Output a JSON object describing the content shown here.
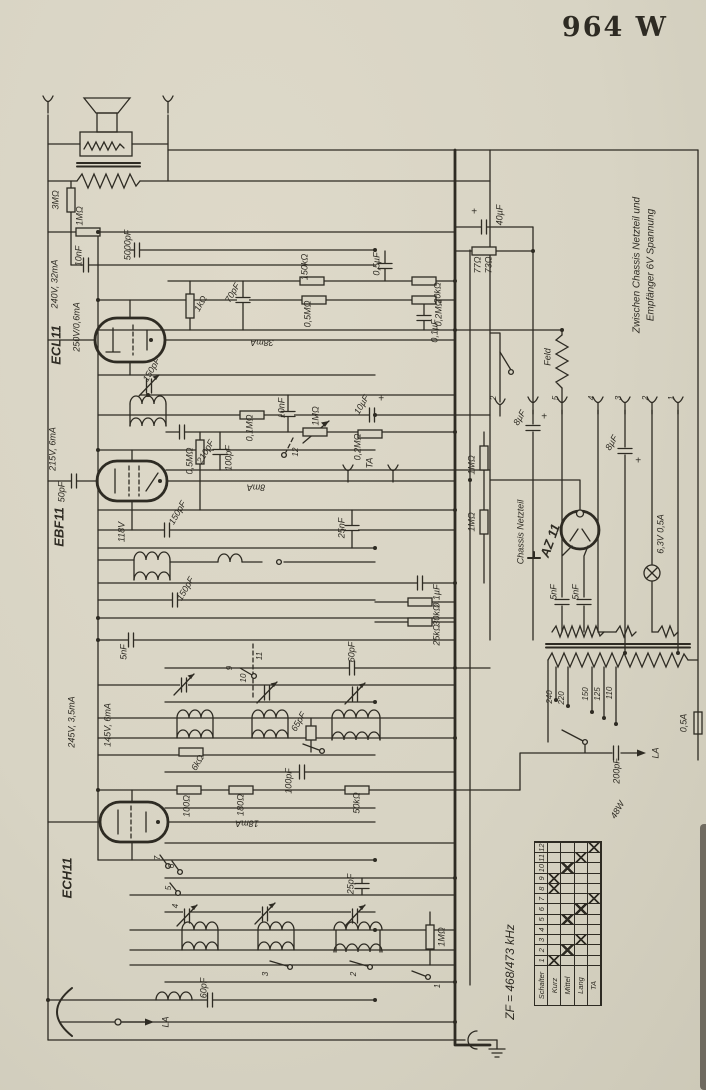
{
  "title": "964 W",
  "colors": {
    "paper": "#d8d4c4",
    "ink": "#2e2b23"
  },
  "switch_table": {
    "header_col": "Schalter",
    "columns": [
      "1",
      "2",
      "3",
      "4",
      "5",
      "6",
      "7",
      "8",
      "9",
      "10",
      "11",
      "12"
    ],
    "rows": [
      {
        "label": "Kurz",
        "marks": [
          1,
          8,
          9
        ]
      },
      {
        "label": "Mittel",
        "marks": [
          2,
          5,
          10
        ]
      },
      {
        "label": "Lang",
        "marks": [
          3,
          6,
          11
        ]
      },
      {
        "label": "TA",
        "marks": [
          7,
          12
        ]
      }
    ]
  },
  "labels": [
    {
      "t": "ECL11",
      "x": 57,
      "y": 345,
      "r": -90,
      "fs": 13,
      "b": 1
    },
    {
      "t": "EBF11",
      "x": 60,
      "y": 527,
      "r": -90,
      "fs": 13,
      "b": 1
    },
    {
      "t": "ECH11",
      "x": 68,
      "y": 878,
      "r": -90,
      "fs": 13,
      "b": 1
    },
    {
      "t": "AZ 11",
      "x": 551,
      "y": 541,
      "r": -70,
      "fs": 13,
      "b": 1
    },
    {
      "t": "3MΩ",
      "x": 56,
      "y": 200,
      "r": -90
    },
    {
      "t": "1MΩ",
      "x": 80,
      "y": 216,
      "r": -90
    },
    {
      "t": "5000pF",
      "x": 128,
      "y": 245,
      "r": -90
    },
    {
      "t": "10nF",
      "x": 79,
      "y": 256,
      "r": -90
    },
    {
      "t": "240V, 32mA",
      "x": 55,
      "y": 284,
      "r": -90
    },
    {
      "t": "250V/0,6mA",
      "x": 77,
      "y": 327,
      "r": -90
    },
    {
      "t": "1kΩ",
      "x": 201,
      "y": 304,
      "r": -60
    },
    {
      "t": "70pF",
      "x": 233,
      "y": 293,
      "r": -60
    },
    {
      "t": "150kΩ",
      "x": 305,
      "y": 267,
      "r": -90
    },
    {
      "t": "0,5µF",
      "x": 377,
      "y": 264,
      "r": -90
    },
    {
      "t": "20kΩ",
      "x": 438,
      "y": 293,
      "r": -90
    },
    {
      "t": "0,5MΩ",
      "x": 308,
      "y": 314,
      "r": -90
    },
    {
      "t": "0,2MΩ",
      "x": 439,
      "y": 313,
      "r": -90
    },
    {
      "t": "0,1µF",
      "x": 435,
      "y": 331,
      "r": -90
    },
    {
      "t": "38mA",
      "x": 262,
      "y": 342,
      "r": 180
    },
    {
      "t": "150pF",
      "x": 152,
      "y": 370,
      "r": -60
    },
    {
      "t": "215V, 6mA",
      "x": 53,
      "y": 449,
      "r": -90
    },
    {
      "t": "50pF",
      "x": 62,
      "y": 492,
      "r": -90
    },
    {
      "t": "118V",
      "x": 122,
      "y": 532,
      "r": -90
    },
    {
      "t": "210pF",
      "x": 206,
      "y": 452,
      "r": -60
    },
    {
      "t": "0,5MΩ",
      "x": 190,
      "y": 461,
      "r": -90
    },
    {
      "t": "100pF",
      "x": 229,
      "y": 458,
      "r": -90
    },
    {
      "t": "0,1MΩ",
      "x": 250,
      "y": 428,
      "r": -90
    },
    {
      "t": "10nF",
      "x": 282,
      "y": 408,
      "r": -90
    },
    {
      "t": "8mA",
      "x": 256,
      "y": 487,
      "r": 180
    },
    {
      "t": "1MΩ",
      "x": 316,
      "y": 416,
      "r": -90
    },
    {
      "t": "12",
      "x": 296,
      "y": 452,
      "r": -90,
      "fs": 8
    },
    {
      "t": "10µF",
      "x": 362,
      "y": 405,
      "r": -60
    },
    {
      "t": "+",
      "x": 381,
      "y": 399,
      "r": 0,
      "fs": 10
    },
    {
      "t": "0,2MΩ",
      "x": 358,
      "y": 447,
      "r": -90
    },
    {
      "t": "TA",
      "x": 370,
      "y": 463,
      "r": -90
    },
    {
      "t": "150pF",
      "x": 178,
      "y": 513,
      "r": -60
    },
    {
      "t": "25nF",
      "x": 342,
      "y": 528,
      "r": -90
    },
    {
      "t": "150pF",
      "x": 186,
      "y": 589,
      "r": -60
    },
    {
      "t": "1MΩ",
      "x": 472,
      "y": 465,
      "r": -90
    },
    {
      "t": "1MΩ",
      "x": 472,
      "y": 522,
      "r": -90
    },
    {
      "t": "245V, 3,5mA",
      "x": 72,
      "y": 722,
      "r": -90
    },
    {
      "t": "145V, 6mA",
      "x": 108,
      "y": 725,
      "r": -90
    },
    {
      "t": "5nF",
      "x": 124,
      "y": 652,
      "r": -90
    },
    {
      "t": "60pF",
      "x": 352,
      "y": 652,
      "r": -90
    },
    {
      "t": "9",
      "x": 230,
      "y": 668,
      "r": -90,
      "fs": 8
    },
    {
      "t": "10",
      "x": 244,
      "y": 678,
      "r": -90,
      "fs": 8
    },
    {
      "t": "11",
      "x": 260,
      "y": 656,
      "r": -90,
      "fs": 8
    },
    {
      "t": "0,1µF",
      "x": 437,
      "y": 596,
      "r": -90
    },
    {
      "t": "30kΩ",
      "x": 437,
      "y": 615,
      "r": -90
    },
    {
      "t": "25kΩ",
      "x": 437,
      "y": 635,
      "r": -90
    },
    {
      "t": "65pF",
      "x": 299,
      "y": 722,
      "r": -60
    },
    {
      "t": "6kΩ",
      "x": 198,
      "y": 763,
      "r": -60
    },
    {
      "t": "100pF",
      "x": 289,
      "y": 781,
      "r": -90
    },
    {
      "t": "100Ω",
      "x": 187,
      "y": 806,
      "r": -90
    },
    {
      "t": "180Ω",
      "x": 241,
      "y": 805,
      "r": -90
    },
    {
      "t": "50kΩ",
      "x": 357,
      "y": 803,
      "r": -90
    },
    {
      "t": "18mA",
      "x": 247,
      "y": 823,
      "r": 180
    },
    {
      "t": "7",
      "x": 158,
      "y": 858,
      "r": -90,
      "fs": 8
    },
    {
      "t": "6",
      "x": 172,
      "y": 866,
      "r": -90,
      "fs": 8
    },
    {
      "t": "5",
      "x": 169,
      "y": 888,
      "r": -90,
      "fs": 8
    },
    {
      "t": "4",
      "x": 176,
      "y": 906,
      "r": -90,
      "fs": 8
    },
    {
      "t": "25pF",
      "x": 351,
      "y": 884,
      "r": -90
    },
    {
      "t": "1MΩ",
      "x": 442,
      "y": 937,
      "r": -90
    },
    {
      "t": "3",
      "x": 266,
      "y": 974,
      "r": -90,
      "fs": 8
    },
    {
      "t": "2",
      "x": 354,
      "y": 974,
      "r": -90,
      "fs": 8
    },
    {
      "t": "1",
      "x": 438,
      "y": 986,
      "r": -90,
      "fs": 8
    },
    {
      "t": "60pF",
      "x": 204,
      "y": 988,
      "r": -90
    },
    {
      "t": "LA",
      "x": 166,
      "y": 1022,
      "r": -90
    },
    {
      "t": "ZF = 468/473 kHz",
      "x": 511,
      "y": 972,
      "r": -90,
      "fs": 12
    },
    {
      "t": "8µF",
      "x": 520,
      "y": 418,
      "r": -60
    },
    {
      "t": "+",
      "x": 544,
      "y": 417,
      "r": 0,
      "fs": 10
    },
    {
      "t": "8µF",
      "x": 612,
      "y": 443,
      "r": -60
    },
    {
      "t": "+",
      "x": 638,
      "y": 461,
      "r": 0,
      "fs": 10
    },
    {
      "t": "Chassis Netzteil",
      "x": 521,
      "y": 532,
      "r": -90
    },
    {
      "t": "5nF",
      "x": 554,
      "y": 592,
      "r": -90
    },
    {
      "t": "5nF",
      "x": 576,
      "y": 592,
      "r": -90
    },
    {
      "t": "6,3V 0,5A",
      "x": 661,
      "y": 534,
      "r": -90
    },
    {
      "t": "Feld",
      "x": 548,
      "y": 357,
      "r": -90
    },
    {
      "t": "77Ω",
      "x": 478,
      "y": 265,
      "r": -90
    },
    {
      "t": "73Ω",
      "x": 489,
      "y": 265,
      "r": -90
    },
    {
      "t": "40µF",
      "x": 500,
      "y": 215,
      "r": -90
    },
    {
      "t": "+",
      "x": 474,
      "y": 212,
      "r": 0,
      "fs": 10
    },
    {
      "t": "Zwischen Chassis Netzteil und",
      "x": 637,
      "y": 265,
      "r": -90,
      "fs": 10
    },
    {
      "t": "Empfänger 6V Spannung",
      "x": 651,
      "y": 265,
      "r": -90,
      "fs": 10
    },
    {
      "t": "240",
      "x": 550,
      "y": 697,
      "r": -90,
      "fs": 8
    },
    {
      "t": "220",
      "x": 562,
      "y": 698,
      "r": -90,
      "fs": 8
    },
    {
      "t": "150",
      "x": 586,
      "y": 694,
      "r": -90,
      "fs": 8
    },
    {
      "t": "125",
      "x": 598,
      "y": 694,
      "r": -90,
      "fs": 8
    },
    {
      "t": "110",
      "x": 610,
      "y": 693,
      "r": -90,
      "fs": 8
    },
    {
      "t": "0,5A",
      "x": 684,
      "y": 723,
      "r": -90
    },
    {
      "t": "200pF",
      "x": 617,
      "y": 771,
      "r": -90
    },
    {
      "t": "LA",
      "x": 656,
      "y": 753,
      "r": -90
    },
    {
      "t": "48W",
      "x": 618,
      "y": 810,
      "r": -60
    },
    {
      "t": "2",
      "x": 494,
      "y": 398,
      "r": -90,
      "fs": 8
    },
    {
      "t": "5",
      "x": 556,
      "y": 398,
      "r": -90,
      "fs": 8
    },
    {
      "t": "4",
      "x": 592,
      "y": 398,
      "r": -90,
      "fs": 8
    },
    {
      "t": "3",
      "x": 619,
      "y": 398,
      "r": -90,
      "fs": 8
    },
    {
      "t": "2",
      "x": 646,
      "y": 398,
      "r": -90,
      "fs": 8
    },
    {
      "t": "1",
      "x": 672,
      "y": 398,
      "r": -90,
      "fs": 8
    }
  ]
}
